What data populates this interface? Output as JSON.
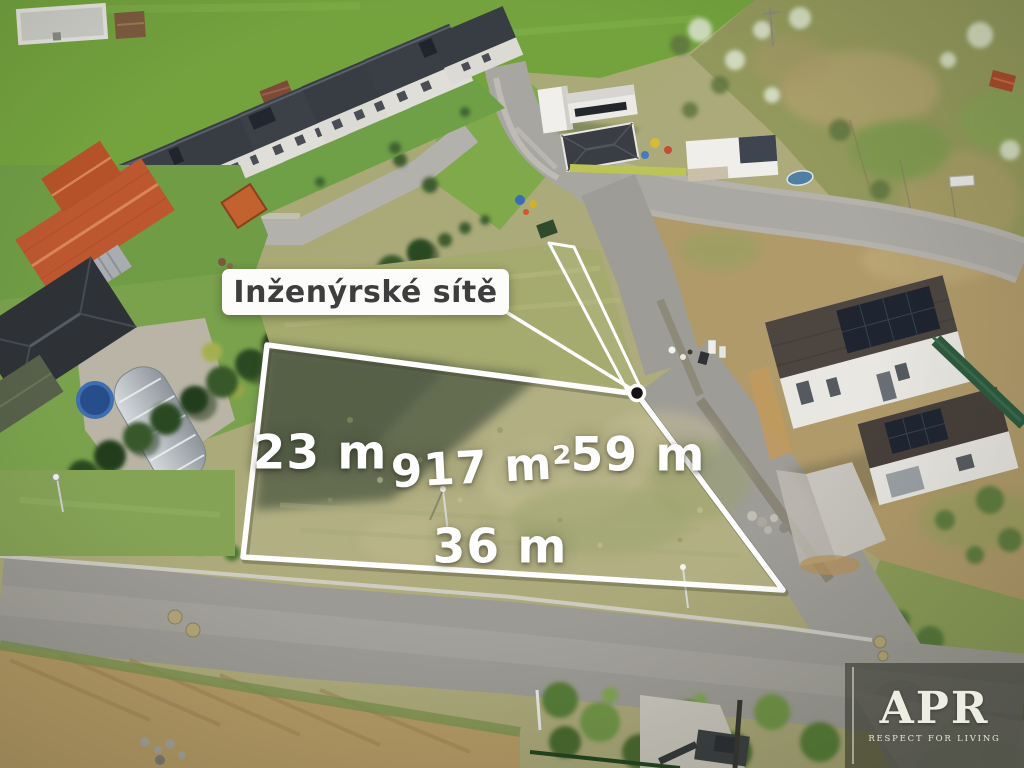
{
  "annotation": {
    "utilities_label": "Inženýrské sítě",
    "area": "917 m²",
    "side_left": "23 m",
    "side_right": "59 m",
    "side_bottom": "36 m"
  },
  "watermark": {
    "brand": "APR",
    "tagline": "RESPECT FOR LIVING"
  },
  "colors": {
    "plot_outline": "#ffffff",
    "label_bg": "#fcfcfa",
    "label_text": "#3e3e3e",
    "marker_dot": "#141414"
  }
}
